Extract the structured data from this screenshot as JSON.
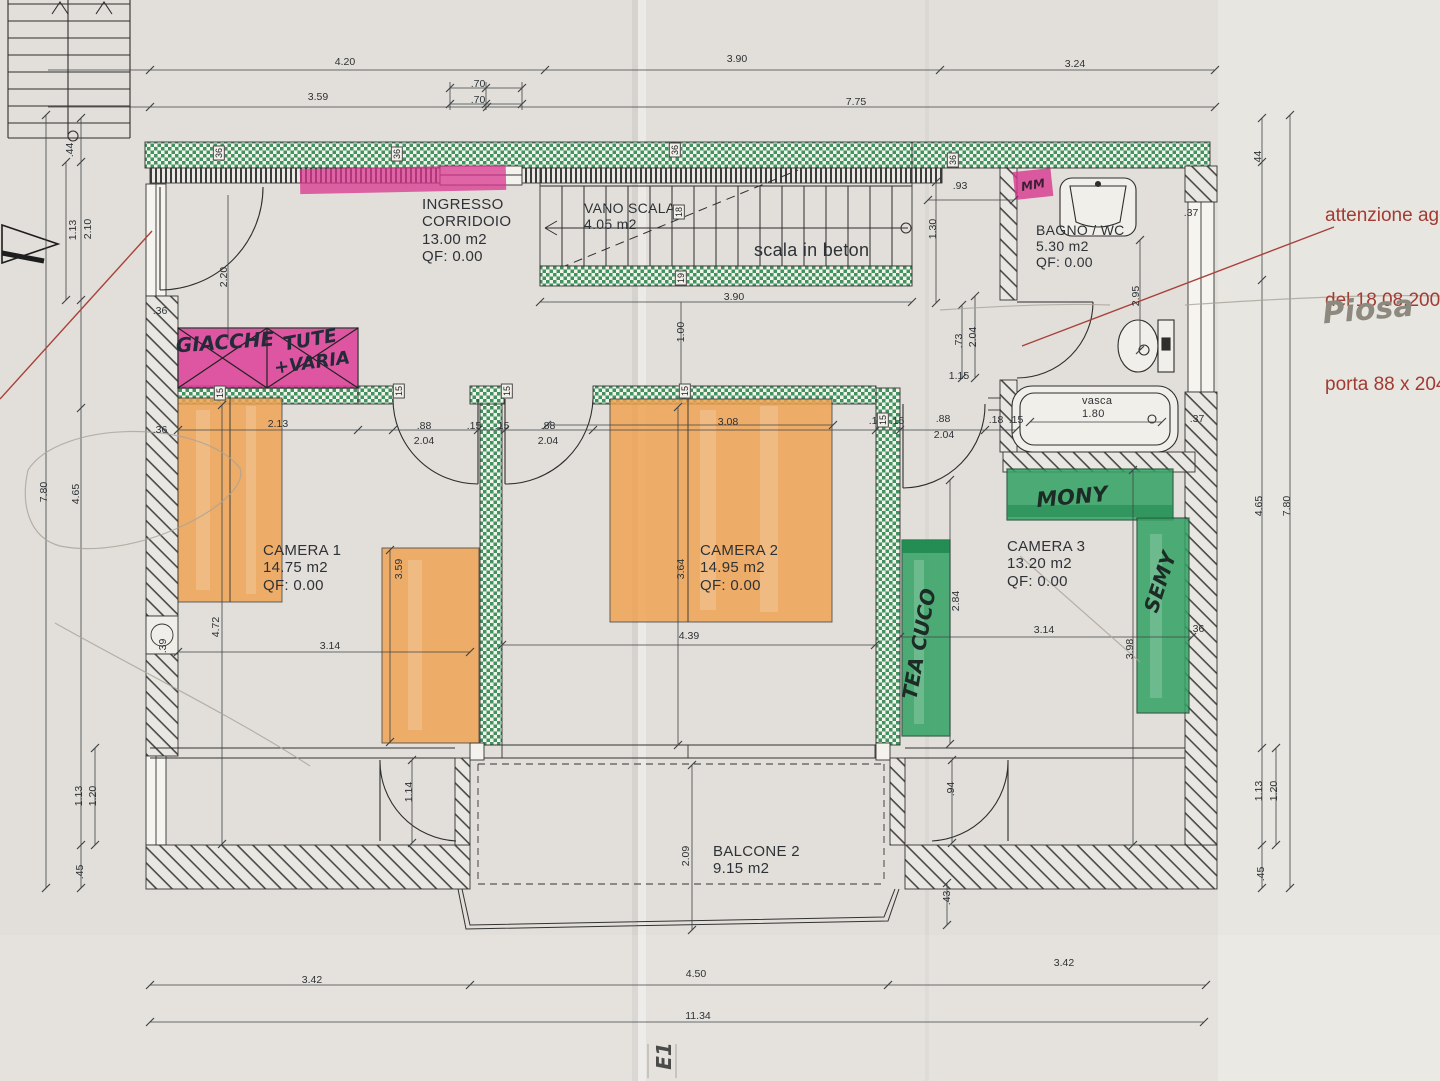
{
  "annotation": {
    "lines": [
      "attenzione agg",
      "del 18.08.2008",
      "porta 88 x 204"
    ]
  },
  "rooms": [
    {
      "id": "ingresso",
      "lines": [
        "INGRESSO",
        "CORRIDOIO",
        "13.00 m2",
        "QF: 0.00"
      ],
      "x": 422,
      "y": 196,
      "fs": 15
    },
    {
      "id": "vano-scala",
      "lines": [
        "VANO SCALA",
        "4.05 m2"
      ],
      "x": 584,
      "y": 200,
      "fs": 14
    },
    {
      "id": "scala-note",
      "lines": [
        "scala in beton"
      ],
      "x": 754,
      "y": 240,
      "fs": 18
    },
    {
      "id": "bagno-wc",
      "lines": [
        "BAGNO / WC",
        "5.30 m2",
        "QF: 0.00"
      ],
      "x": 1036,
      "y": 222,
      "fs": 14
    },
    {
      "id": "camera-1",
      "lines": [
        "CAMERA 1",
        "14.75 m2",
        "QF: 0.00"
      ],
      "x": 263,
      "y": 542,
      "fs": 15
    },
    {
      "id": "camera-2",
      "lines": [
        "CAMERA 2",
        "14.95 m2",
        "QF: 0.00"
      ],
      "x": 700,
      "y": 542,
      "fs": 15
    },
    {
      "id": "camera-3",
      "lines": [
        "CAMERA 3",
        "13.20 m2",
        "QF: 0.00"
      ],
      "x": 1007,
      "y": 538,
      "fs": 15
    },
    {
      "id": "balcone-2",
      "lines": [
        "BALCONE 2",
        "9.15 m2"
      ],
      "x": 713,
      "y": 843,
      "fs": 15
    },
    {
      "id": "vasca",
      "lines": [
        "vasca",
        "1.80"
      ],
      "x": 1082,
      "y": 395,
      "fs": 11
    }
  ],
  "dimensions": [
    {
      "t": "4.20",
      "x": 345,
      "y": 62
    },
    {
      "t": "3.90",
      "x": 737,
      "y": 59
    },
    {
      "t": "3.24",
      "x": 1075,
      "y": 64
    },
    {
      "t": "3.59",
      "x": 318,
      "y": 97
    },
    {
      "t": "7.75",
      "x": 856,
      "y": 102
    },
    {
      "t": ".70",
      "x": 478,
      "y": 84
    },
    {
      "t": ".70",
      "x": 478,
      "y": 100
    },
    {
      "t": ".44",
      "x": 70,
      "y": 150,
      "r": -90
    },
    {
      "t": "1.13",
      "x": 73,
      "y": 230,
      "r": -90
    },
    {
      "t": "2.10",
      "x": 88,
      "y": 229,
      "r": -90
    },
    {
      "t": "7.80",
      "x": 44,
      "y": 492,
      "r": -90
    },
    {
      "t": "4.65",
      "x": 76,
      "y": 494,
      "r": -90
    },
    {
      "t": "1.13",
      "x": 79,
      "y": 796,
      "r": -90
    },
    {
      "t": "1.20",
      "x": 93,
      "y": 796,
      "r": -90
    },
    {
      "t": ".45",
      "x": 80,
      "y": 872,
      "r": -90
    },
    {
      "t": ".36",
      "x": 160,
      "y": 311
    },
    {
      "t": ".36",
      "x": 160,
      "y": 430
    },
    {
      "t": ".39",
      "x": 163,
      "y": 646,
      "r": -90
    },
    {
      "t": "2.20",
      "x": 224,
      "y": 277,
      "r": -90
    },
    {
      "t": "2.13",
      "x": 278,
      "y": 424
    },
    {
      "t": ".88",
      "x": 424,
      "y": 426
    },
    {
      "t": "2.04",
      "x": 424,
      "y": 441
    },
    {
      "t": ".15",
      "x": 474,
      "y": 426
    },
    {
      "t": ".15",
      "x": 502,
      "y": 426
    },
    {
      "t": ".88",
      "x": 548,
      "y": 426
    },
    {
      "t": "2.04",
      "x": 548,
      "y": 441
    },
    {
      "t": "3.08",
      "x": 728,
      "y": 422
    },
    {
      "t": ".12",
      "x": 876,
      "y": 421
    },
    {
      "t": ".15",
      "x": 897,
      "y": 421
    },
    {
      "t": ".88",
      "x": 943,
      "y": 419
    },
    {
      "t": "2.04",
      "x": 944,
      "y": 435
    },
    {
      "t": ".18",
      "x": 996,
      "y": 420
    },
    {
      "t": ".15",
      "x": 1016,
      "y": 420
    },
    {
      "t": "3.90",
      "x": 734,
      "y": 297
    },
    {
      "t": "1.00",
      "x": 681,
      "y": 332,
      "r": -90
    },
    {
      "t": ".93",
      "x": 960,
      "y": 186
    },
    {
      "t": "1.30",
      "x": 933,
      "y": 229,
      "r": -90
    },
    {
      "t": "2.95",
      "x": 1136,
      "y": 296,
      "r": -90
    },
    {
      "t": ".73",
      "x": 959,
      "y": 341,
      "r": -90
    },
    {
      "t": "2.04",
      "x": 973,
      "y": 337,
      "r": -90
    },
    {
      "t": "1.15",
      "x": 959,
      "y": 376
    },
    {
      "t": ".37",
      "x": 1191,
      "y": 213
    },
    {
      "t": ".44",
      "x": 1258,
      "y": 158,
      "r": -90
    },
    {
      "t": ".37",
      "x": 1197,
      "y": 419
    },
    {
      "t": "4.72",
      "x": 216,
      "y": 627,
      "r": -90
    },
    {
      "t": "3.14",
      "x": 330,
      "y": 646
    },
    {
      "t": "3.59",
      "x": 399,
      "y": 569,
      "r": -90
    },
    {
      "t": "3.64",
      "x": 681,
      "y": 569,
      "r": -90
    },
    {
      "t": "4.39",
      "x": 689,
      "y": 636
    },
    {
      "t": "2.84",
      "x": 956,
      "y": 601,
      "r": -90
    },
    {
      "t": "3.14",
      "x": 1044,
      "y": 630
    },
    {
      "t": "3.98",
      "x": 1130,
      "y": 649,
      "r": -90
    },
    {
      "t": ".36",
      "x": 1197,
      "y": 629
    },
    {
      "t": "4.65",
      "x": 1259,
      "y": 506,
      "r": -90
    },
    {
      "t": "7.80",
      "x": 1287,
      "y": 506,
      "r": -90
    },
    {
      "t": "1.13",
      "x": 1259,
      "y": 791,
      "r": -90
    },
    {
      "t": "1.20",
      "x": 1274,
      "y": 791,
      "r": -90
    },
    {
      "t": ".45",
      "x": 1261,
      "y": 874,
      "r": -90
    },
    {
      "t": "1.14",
      "x": 409,
      "y": 792,
      "r": -90
    },
    {
      "t": "2.09",
      "x": 686,
      "y": 856,
      "r": -90
    },
    {
      "t": ".94",
      "x": 951,
      "y": 789,
      "r": -90
    },
    {
      "t": ".43",
      "x": 947,
      "y": 898,
      "r": -90
    },
    {
      "t": "3.42",
      "x": 312,
      "y": 980
    },
    {
      "t": "4.50",
      "x": 696,
      "y": 974
    },
    {
      "t": "3.42",
      "x": 1064,
      "y": 963
    },
    {
      "t": "11.34",
      "x": 698,
      "y": 1016
    }
  ],
  "wall_tags": [
    {
      "t": "36",
      "x": 219,
      "y": 153
    },
    {
      "t": "36",
      "x": 397,
      "y": 154
    },
    {
      "t": "36",
      "x": 675,
      "y": 150
    },
    {
      "t": "36",
      "x": 953,
      "y": 160
    },
    {
      "t": "15",
      "x": 220,
      "y": 393
    },
    {
      "t": "15",
      "x": 399,
      "y": 391
    },
    {
      "t": "15",
      "x": 507,
      "y": 391
    },
    {
      "t": "15",
      "x": 685,
      "y": 391
    },
    {
      "t": "15",
      "x": 883,
      "y": 420
    },
    {
      "t": "18",
      "x": 679,
      "y": 212
    },
    {
      "t": "19",
      "x": 681,
      "y": 278
    }
  ],
  "handwriting": [
    {
      "t": "GIACCHE",
      "x": 225,
      "y": 342,
      "r": -4,
      "fs": 20,
      "c": "#232a38"
    },
    {
      "t": "TUTE",
      "x": 310,
      "y": 340,
      "r": -10,
      "fs": 19,
      "c": "#232a38"
    },
    {
      "t": "+VARIA",
      "x": 312,
      "y": 363,
      "r": -8,
      "fs": 18,
      "c": "#232a38"
    },
    {
      "t": "MONY",
      "x": 1072,
      "y": 497,
      "r": -5,
      "fs": 21,
      "c": "#1d2b26"
    },
    {
      "t": "SEMY",
      "x": 1160,
      "y": 582,
      "r": -72,
      "fs": 20,
      "c": "#1d2b26"
    },
    {
      "t": "TEA CUCO",
      "x": 919,
      "y": 644,
      "r": -80,
      "fs": 20,
      "c": "#1d2b26"
    },
    {
      "t": "MM",
      "x": 1033,
      "y": 185,
      "r": -10,
      "fs": 12,
      "c": "#3a1f33"
    },
    {
      "t": "Piosa",
      "x": 1368,
      "y": 310,
      "r": -5,
      "fs": 30,
      "c": "#8d897f"
    },
    {
      "t": "E1",
      "x": 664,
      "y": 1056,
      "r": -90,
      "fs": 20,
      "c": "#4a4a48"
    }
  ],
  "colors": {
    "marker_pink": "#d8368f",
    "marker_orange": "#f0a14e",
    "marker_green": "#33a263",
    "wall_green": "#41925e",
    "annotation_red": "#a23b32",
    "pencil": "#8d897f"
  }
}
